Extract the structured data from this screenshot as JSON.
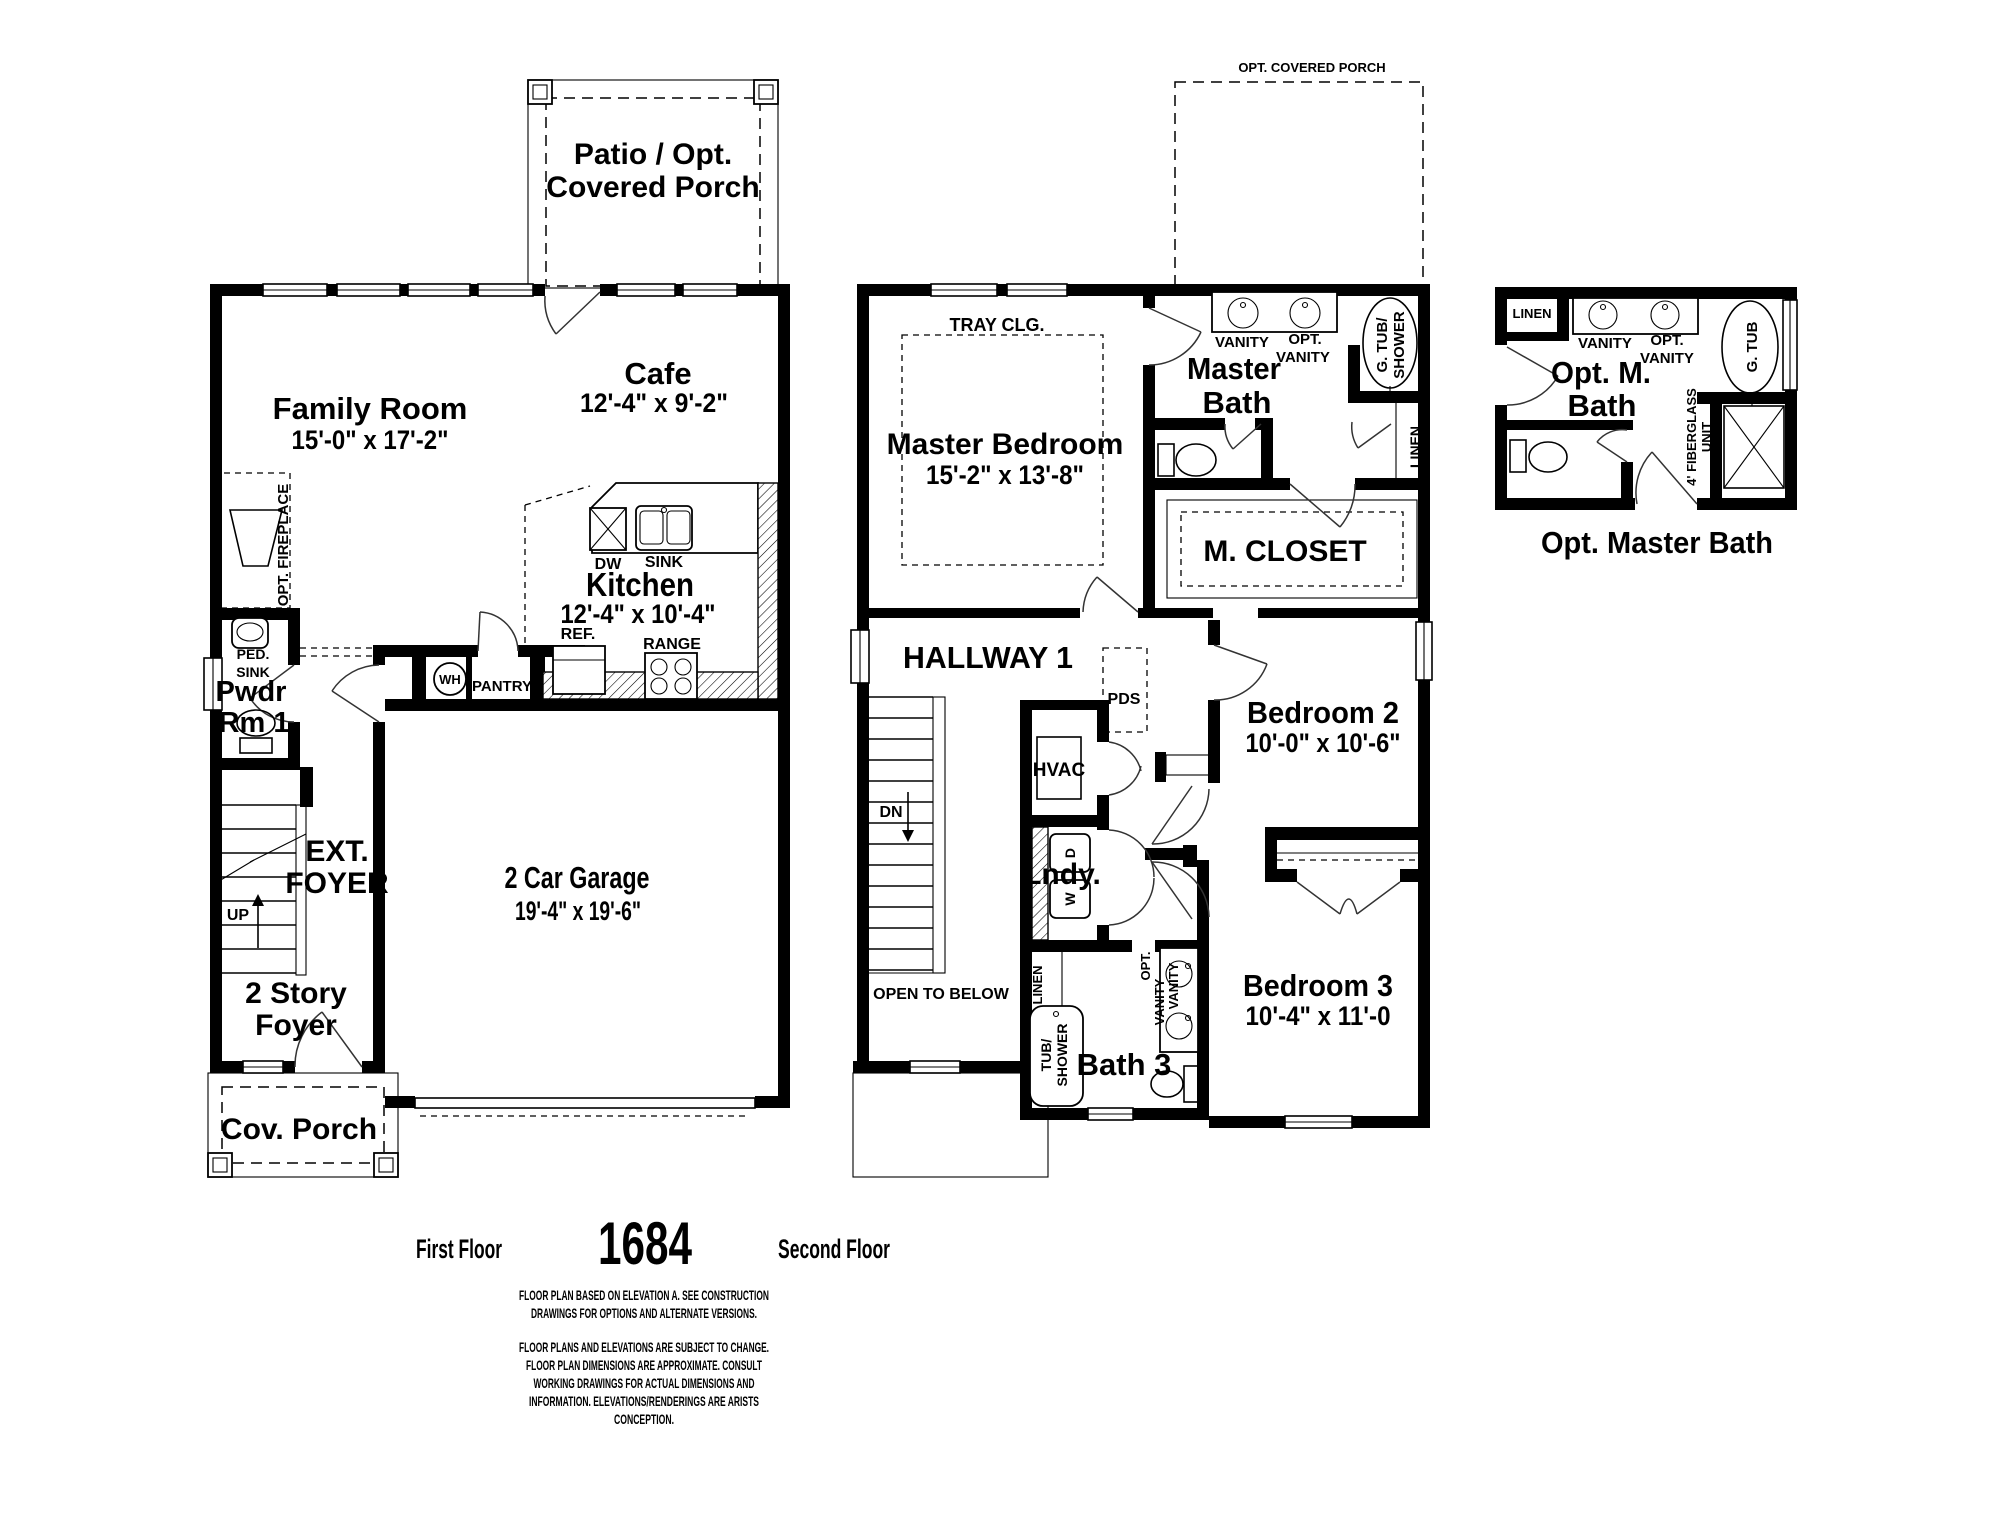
{
  "ff": {
    "patio1": "Patio / Opt.",
    "patio2": "Covered Porch",
    "family": "Family Room",
    "family_dims": "15'-0\" x 17'-2\"",
    "cafe": "Cafe",
    "cafe_dims": "12'-4\" x 9'-2\"",
    "kitchen": "Kitchen",
    "kitchen_dims": "12'-4\" x 10'-4\"",
    "dw": "DW",
    "sink": "SINK",
    "ref": "REF.",
    "range": "RANGE",
    "wh": "WH",
    "pantry": "PANTRY",
    "opt_fireplace": "OPT. FIREPLACE",
    "ped1": "PED.",
    "ped2": "SINK",
    "pwdr1": "Pwdr",
    "pwdr2": "Rm 1",
    "ext1": "EXT.",
    "ext2": "FOYER",
    "up": "UP",
    "foyer1": "2 Story",
    "foyer2": "Foyer",
    "garage": "2 Car Garage",
    "garage_dims": "19'-4\" x 19'-6\"",
    "cov_porch": "Cov. Porch"
  },
  "sf": {
    "opt_porch": "OPT. COVERED PORCH",
    "tray": "TRAY CLG.",
    "mbr": "Master Bedroom",
    "mbr_dims": "15'-2\" x 13'-8\"",
    "master1": "Master",
    "master2": "Bath",
    "vanity": "VANITY",
    "opt1": "OPT.",
    "opt2": "VANITY",
    "gtub1": "G. TUB/",
    "gtub2": "SHOWER",
    "linen": "LINEN",
    "mcloset": "M. CLOSET",
    "hallway": "HALLWAY 1",
    "pds": "PDS",
    "hvac": "HVAC",
    "dn": "DN",
    "lndy": "Lndy.",
    "w": "W",
    "d": "D",
    "br2": "Bedroom 2",
    "br2_dims": "10'-0\" x 10'-6\"",
    "br3": "Bedroom 3",
    "br3_dims": "10'-4\" x 11'-0",
    "bath3": "Bath 3",
    "tub1": "TUB/",
    "tub2": "SHOWER",
    "linen3": "LINEN",
    "opt3": "OPT.",
    "van3a": "VANITY",
    "van3b": "VANITY",
    "open_below": "OPEN TO BELOW"
  },
  "omb": {
    "linen": "LINEN",
    "vanity": "VANITY",
    "opt1": "OPT.",
    "opt2": "VANITY",
    "name1": "Opt. M.",
    "name2": "Bath",
    "gtub": "G. TUB",
    "fg1": "4' FIBERGLASS",
    "fg2": "UNIT",
    "caption": "Opt. Master Bath"
  },
  "footer": {
    "first_floor": "First Floor",
    "plan_number": "1684",
    "second_floor": "Second Floor",
    "disclaimer1": [
      "FLOOR PLAN BASED ON ELEVATION A. SEE CONSTRUCTION",
      "DRAWINGS FOR OPTIONS AND ALTERNATE VERSIONS."
    ],
    "disclaimer2": [
      "FLOOR PLANS AND ELEVATIONS ARE SUBJECT TO CHANGE.",
      "FLOOR PLAN DIMENSIONS ARE APPROXIMATE. CONSULT",
      "WORKING DRAWINGS FOR ACTUAL DIMENSIONS AND",
      "INFORMATION. ELEVATIONS/RENDERINGS ARE ARISTS",
      "CONCEPTION."
    ]
  }
}
